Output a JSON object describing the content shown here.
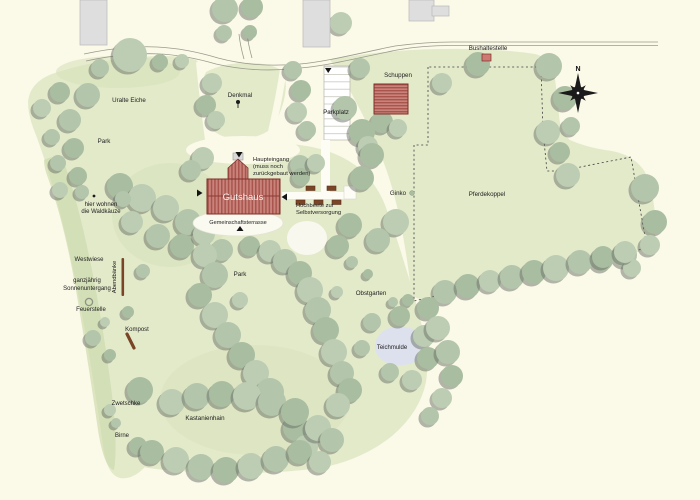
{
  "map": {
    "compass_n": "N",
    "building_labels": {
      "gutshaus": "Gutshaus"
    },
    "region_labels": [
      {
        "id": "bushaltestelle",
        "text": "Bushaltestelle",
        "x": 488,
        "y": 50,
        "anchor": "middle",
        "size": 6.2
      },
      {
        "id": "schuppen",
        "text": "Schuppen",
        "x": 398,
        "y": 77,
        "anchor": "middle",
        "size": 6.2
      },
      {
        "id": "denkmal",
        "text": "Denkmal",
        "x": 240,
        "y": 97,
        "anchor": "middle",
        "size": 6.2
      },
      {
        "id": "parkplatz",
        "text": "Parkplatz",
        "x": 336,
        "y": 114,
        "anchor": "middle",
        "size": 6.2
      },
      {
        "id": "uralte-eiche",
        "text": "Uralte Eiche",
        "x": 129,
        "y": 102,
        "anchor": "middle",
        "size": 6.2
      },
      {
        "id": "park-west",
        "text": "Park",
        "x": 104,
        "y": 143,
        "anchor": "middle",
        "size": 6.2
      },
      {
        "id": "haupteingang-1",
        "text": "Haupteingang",
        "x": 253,
        "y": 161,
        "anchor": "start",
        "size": 5.8
      },
      {
        "id": "haupteingang-2",
        "text": "(muss noch",
        "x": 253,
        "y": 168,
        "anchor": "start",
        "size": 5.8
      },
      {
        "id": "haupteingang-3",
        "text": "zurückgebaut werden)",
        "x": 253,
        "y": 175,
        "anchor": "start",
        "size": 5.8
      },
      {
        "id": "terrasse",
        "text": "Gemeinschaftsterrasse",
        "x": 238,
        "y": 224,
        "anchor": "middle",
        "size": 5.6
      },
      {
        "id": "hochbeete-1",
        "text": "Hochbeete zur",
        "x": 296,
        "y": 207,
        "anchor": "start",
        "size": 5.8
      },
      {
        "id": "hochbeete-2",
        "text": "Selbstversorgung",
        "x": 296,
        "y": 214,
        "anchor": "start",
        "size": 5.8
      },
      {
        "id": "ginko",
        "text": "Ginko",
        "x": 398,
        "y": 195,
        "anchor": "middle",
        "size": 6.2
      },
      {
        "id": "pferdekoppel",
        "text": "Pferdekoppel",
        "x": 487,
        "y": 196,
        "anchor": "middle",
        "size": 6.2
      },
      {
        "id": "waldkauze-1",
        "text": "hier wohnen",
        "x": 101,
        "y": 206,
        "anchor": "middle",
        "size": 6
      },
      {
        "id": "waldkauze-2",
        "text": "die Waldkäuze",
        "x": 101,
        "y": 213,
        "anchor": "middle",
        "size": 6
      },
      {
        "id": "westwiese",
        "text": "Westwiese",
        "x": 89,
        "y": 261,
        "anchor": "middle",
        "size": 6
      },
      {
        "id": "abendbaenke",
        "text": "Abendbänke",
        "x": 116,
        "y": 277,
        "anchor": "middle",
        "size": 5.8,
        "rot": -90
      },
      {
        "id": "sonnenuntergang-1",
        "text": "ganzjährig",
        "x": 87,
        "y": 282,
        "anchor": "middle",
        "size": 6
      },
      {
        "id": "sonnenuntergang-2",
        "text": "Sonnenuntergang",
        "x": 87,
        "y": 290,
        "anchor": "middle",
        "size": 6
      },
      {
        "id": "feuerstelle",
        "text": "Feuerstelle",
        "x": 91,
        "y": 311,
        "anchor": "middle",
        "size": 6
      },
      {
        "id": "kompost",
        "text": "Kompost",
        "x": 137,
        "y": 331,
        "anchor": "middle",
        "size": 6
      },
      {
        "id": "zwetschke",
        "text": "Zwetschke",
        "x": 126,
        "y": 405,
        "anchor": "middle",
        "size": 6
      },
      {
        "id": "birne",
        "text": "Birne",
        "x": 122,
        "y": 437,
        "anchor": "middle",
        "size": 6
      },
      {
        "id": "kastanienhain",
        "text": "Kastanienhain",
        "x": 205,
        "y": 420,
        "anchor": "middle",
        "size": 6.2
      },
      {
        "id": "park-center",
        "text": "Park",
        "x": 240,
        "y": 276,
        "anchor": "middle",
        "size": 6.2
      },
      {
        "id": "obstgarten",
        "text": "Obstgarten",
        "x": 371,
        "y": 295,
        "anchor": "middle",
        "size": 6.2
      },
      {
        "id": "teichmulde",
        "text": "Teichmulde",
        "x": 392,
        "y": 349,
        "anchor": "middle",
        "size": 6
      }
    ],
    "colors": {
      "background": "#fbf9e8",
      "grass": "#e3eaca",
      "grass_dark": "#d5e0b8",
      "grass_band": "#cbd9ab",
      "tree_shades": [
        "#b3c5ab",
        "#a9bda1",
        "#bccdb3"
      ],
      "tree_shadow": "rgba(106,112,102,0.5)",
      "building_gray": "#dedede",
      "roof_red": "#c8837b",
      "roof_red_stripe": "#a9544d",
      "roof_red_border": "#7e2f28",
      "road": "#9a9a8b",
      "pond": "#dde1ee",
      "wood": "#7a4527",
      "white_area": "#fdfdf6",
      "text": "#1c1c1c"
    },
    "icons": {
      "compass": "compass-rose-icon",
      "bus_stop": "bus-stop-marker",
      "memorial": "memorial-marker",
      "fire_pit": "fire-pit-ring-marker",
      "benches": "bench-row-marker",
      "compost": "compost-marker",
      "entrance_arrows": [
        "arrow-down-icon",
        "arrow-down-icon",
        "arrow-right-icon",
        "arrow-left-icon",
        "arrow-up-icon"
      ]
    },
    "trees": [
      [
        225,
        9,
        13
      ],
      [
        252,
        7,
        11
      ],
      [
        341,
        23,
        11
      ],
      [
        224,
        33,
        8
      ],
      [
        250,
        32,
        7
      ],
      [
        130,
        55,
        17
      ],
      [
        100,
        68,
        9
      ],
      [
        160,
        62,
        8
      ],
      [
        182,
        61,
        7
      ],
      [
        360,
        68,
        10
      ],
      [
        478,
        64,
        12
      ],
      [
        442,
        83,
        10
      ],
      [
        549,
        66,
        13
      ],
      [
        565,
        98,
        12
      ],
      [
        548,
        132,
        12
      ],
      [
        571,
        126,
        9
      ],
      [
        560,
        152,
        10
      ],
      [
        568,
        175,
        12
      ],
      [
        88,
        95,
        12
      ],
      [
        60,
        92,
        10
      ],
      [
        212,
        83,
        10
      ],
      [
        293,
        70,
        9
      ],
      [
        301,
        90,
        10
      ],
      [
        42,
        108,
        9
      ],
      [
        70,
        120,
        11
      ],
      [
        206,
        105,
        10
      ],
      [
        297,
        112,
        10
      ],
      [
        345,
        108,
        12
      ],
      [
        382,
        122,
        11
      ],
      [
        398,
        128,
        9
      ],
      [
        52,
        137,
        8
      ],
      [
        74,
        148,
        10
      ],
      [
        216,
        120,
        9
      ],
      [
        307,
        130,
        9
      ],
      [
        362,
        132,
        13
      ],
      [
        368,
        146,
        10
      ],
      [
        58,
        163,
        8
      ],
      [
        78,
        176,
        9
      ],
      [
        203,
        158,
        11
      ],
      [
        191,
        170,
        10
      ],
      [
        372,
        155,
        12
      ],
      [
        60,
        190,
        8
      ],
      [
        82,
        192,
        7
      ],
      [
        120,
        186,
        13
      ],
      [
        142,
        198,
        14
      ],
      [
        123,
        199,
        8
      ],
      [
        362,
        178,
        12
      ],
      [
        166,
        208,
        13
      ],
      [
        188,
        222,
        13
      ],
      [
        350,
        225,
        12
      ],
      [
        396,
        222,
        13
      ],
      [
        378,
        240,
        12
      ],
      [
        338,
        246,
        11
      ],
      [
        132,
        222,
        11
      ],
      [
        158,
        236,
        12
      ],
      [
        182,
        246,
        12
      ],
      [
        204,
        234,
        11
      ],
      [
        300,
        165,
        10
      ],
      [
        301,
        177,
        9
      ],
      [
        316,
        163,
        9
      ],
      [
        645,
        188,
        14
      ],
      [
        655,
        222,
        12
      ],
      [
        650,
        245,
        10
      ],
      [
        625,
        255,
        12
      ],
      [
        602,
        260,
        11
      ],
      [
        632,
        268,
        9
      ],
      [
        222,
        250,
        11
      ],
      [
        250,
        246,
        10
      ],
      [
        270,
        251,
        11
      ],
      [
        143,
        271,
        7
      ],
      [
        128,
        312,
        6
      ],
      [
        105,
        322,
        5
      ],
      [
        93,
        338,
        8
      ],
      [
        110,
        355,
        6
      ],
      [
        205,
        255,
        12
      ],
      [
        215,
        275,
        13
      ],
      [
        200,
        295,
        12
      ],
      [
        215,
        315,
        13
      ],
      [
        228,
        335,
        13
      ],
      [
        242,
        355,
        13
      ],
      [
        256,
        373,
        13
      ],
      [
        270,
        392,
        14
      ],
      [
        296,
        428,
        13
      ],
      [
        306,
        447,
        12
      ],
      [
        285,
        261,
        12
      ],
      [
        300,
        273,
        12
      ],
      [
        310,
        290,
        13
      ],
      [
        318,
        310,
        13
      ],
      [
        326,
        330,
        13
      ],
      [
        334,
        352,
        13
      ],
      [
        342,
        373,
        12
      ],
      [
        350,
        390,
        12
      ],
      [
        338,
        405,
        12
      ],
      [
        352,
        262,
        6
      ],
      [
        368,
        274,
        5
      ],
      [
        337,
        292,
        6
      ],
      [
        393,
        302,
        5
      ],
      [
        408,
        300,
        6
      ],
      [
        240,
        300,
        8
      ],
      [
        445,
        292,
        12
      ],
      [
        468,
        286,
        12
      ],
      [
        490,
        281,
        11
      ],
      [
        512,
        277,
        12
      ],
      [
        534,
        272,
        12
      ],
      [
        556,
        268,
        13
      ],
      [
        580,
        262,
        12
      ],
      [
        603,
        257,
        11
      ],
      [
        625,
        252,
        11
      ],
      [
        372,
        322,
        9
      ],
      [
        400,
        316,
        10
      ],
      [
        424,
        336,
        11
      ],
      [
        362,
        348,
        8
      ],
      [
        428,
        358,
        11
      ],
      [
        412,
        380,
        10
      ],
      [
        390,
        372,
        9
      ],
      [
        428,
        308,
        11
      ],
      [
        438,
        328,
        12
      ],
      [
        448,
        352,
        12
      ],
      [
        452,
        376,
        11
      ],
      [
        442,
        398,
        10
      ],
      [
        430,
        416,
        9
      ],
      [
        140,
        390,
        13
      ],
      [
        110,
        410,
        6
      ],
      [
        116,
        423,
        5
      ],
      [
        138,
        446,
        9
      ],
      [
        172,
        402,
        13
      ],
      [
        197,
        396,
        13
      ],
      [
        222,
        394,
        13
      ],
      [
        247,
        396,
        14
      ],
      [
        272,
        402,
        14
      ],
      [
        295,
        412,
        14
      ],
      [
        318,
        428,
        13
      ],
      [
        332,
        440,
        12
      ],
      [
        152,
        452,
        12
      ],
      [
        176,
        460,
        13
      ],
      [
        201,
        467,
        13
      ],
      [
        226,
        470,
        13
      ],
      [
        251,
        466,
        13
      ],
      [
        276,
        459,
        13
      ],
      [
        300,
        452,
        12
      ],
      [
        320,
        462,
        11
      ]
    ]
  }
}
